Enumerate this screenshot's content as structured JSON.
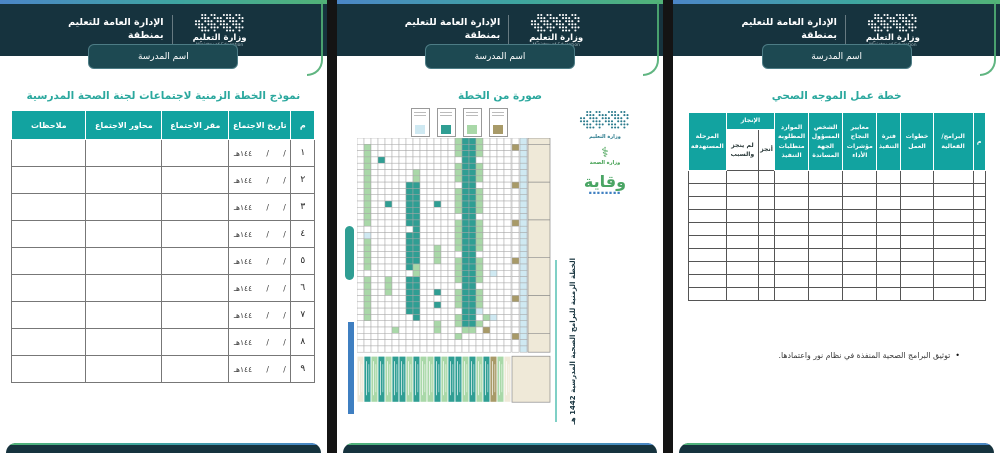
{
  "shared": {
    "ministry_logo": {
      "title_ar": "وزارة التعليم",
      "subtitle_en": "Ministry of Education"
    },
    "org": {
      "line1": "الإدارة العامة للتعليم",
      "line2": "بمنطقة"
    },
    "school_banner": "اسم المدرسة"
  },
  "colors": {
    "header_dark": "#16333e",
    "title_teal": "#2ba89e",
    "table_head_teal": "#12a3a0",
    "accent_green": "#52b377",
    "accent_blue": "#4b86c7"
  },
  "pages": [
    {
      "id": "meetings-plan",
      "title": "نموذج الخطة الزمنية لاجتماعات لجنة الصحة المدرسية",
      "table": {
        "headers": [
          "م",
          "تاريخ الاجتماع",
          "مقر الاجتماع",
          "محاور الاجتماع",
          "ملاحظات"
        ],
        "date_value": "/      /      ١٤٤هـ",
        "row_numbers": [
          "١",
          "٢",
          "٣",
          "٤",
          "٥",
          "٦",
          "٧",
          "٨",
          "٩"
        ]
      }
    },
    {
      "id": "plan-photo",
      "title": "صورة من الخطة",
      "plan_image": {
        "side_caption": "الخطة الزمنية للبرامج الصحية المدرسية 1442 هـ",
        "logos": {
          "education_ar": "وزارة التعليم",
          "health_ar": "وزارة الصحة",
          "weqaya_ar": "وقاية"
        },
        "legend_colors": [
          "#cfe9f2",
          "#2f9e93",
          "#a9d8a8",
          "#a89a68"
        ],
        "palette": {
          "G": "#a9d8a8",
          "T": "#2f9e93",
          "B": "#cfe9f2",
          "K": "#a89a68",
          "E": "#efe9d8"
        },
        "grid_rows": [
          "..............GTTG....",
          ".G............GTTG....",
          ".G............GTTG....",
          ".G.T...........TT.....",
          ".G............GTTG....",
          ".G......G.....GTTG....",
          ".G......G.....GTTG....",
          ".G.....TT......TT.....",
          ".G.....TT.....GTTG....",
          ".G.....TT.....GTTG....",
          ".G..T..TT..T..GTTG....",
          ".G.....TT.....GTTG....",
          ".G.....TT......TT.....",
          ".G.....TT.....GTTG....",
          "........T.....GTTG....",
          ".B.....TT.....GTTG....",
          ".G.....TT.....GTTG....",
          ".G.....TT..G..GTTG....",
          ".G.....TT..G...TT.....",
          ".G.....TT..G..GTTG....",
          ".G.....TG.....GTTG....",
          "........G.....GTTG.B..",
          ".G..G..TT.....GTTG....",
          ".G..G..TT......TT.....",
          ".G..G..TT..T..GTTG....",
          ".G.....TT.....GTTG....",
          ".G.....TT..T..GTTG....",
          ".G.....TT......TTB....",
          ".G......T.....GTT.GB..",
          "...........G..GTTG....",
          ".....G.....G...GG.K...",
          "..............G.......",
          "......................",
          "......................"
        ],
        "separator_rows": [
          1,
          7,
          13,
          19,
          25,
          31
        ],
        "bottom_cells": "ETGTGTTGTGGTGTTGTGTKGE"
      }
    },
    {
      "id": "health-guide-plan",
      "title": "خطة عمل الموجه الصحي",
      "table": {
        "col_headers": [
          "م",
          "البرامج/\nالفعالية",
          "خطوات\nالعمل",
          "فترة\nالتنفيذ",
          "معايير النجاح\nمؤشرات\nالأداء",
          "الشخص\nالمسؤول\nالجهة\nالمساندة",
          "الموارد\nالمطلوبة\nمتطلبات\nالتنفيذ"
        ],
        "achievement": {
          "label": "الإنجاز",
          "done": "أنجز",
          "not_done": "لم ينجز\nوالسبب"
        },
        "last_header": "المرحلة\nالمستهدفة",
        "empty_row_count": 10
      },
      "note": "توثيق البرامج الصحية المنفذة في نظام نور واعتمادها."
    }
  ]
}
